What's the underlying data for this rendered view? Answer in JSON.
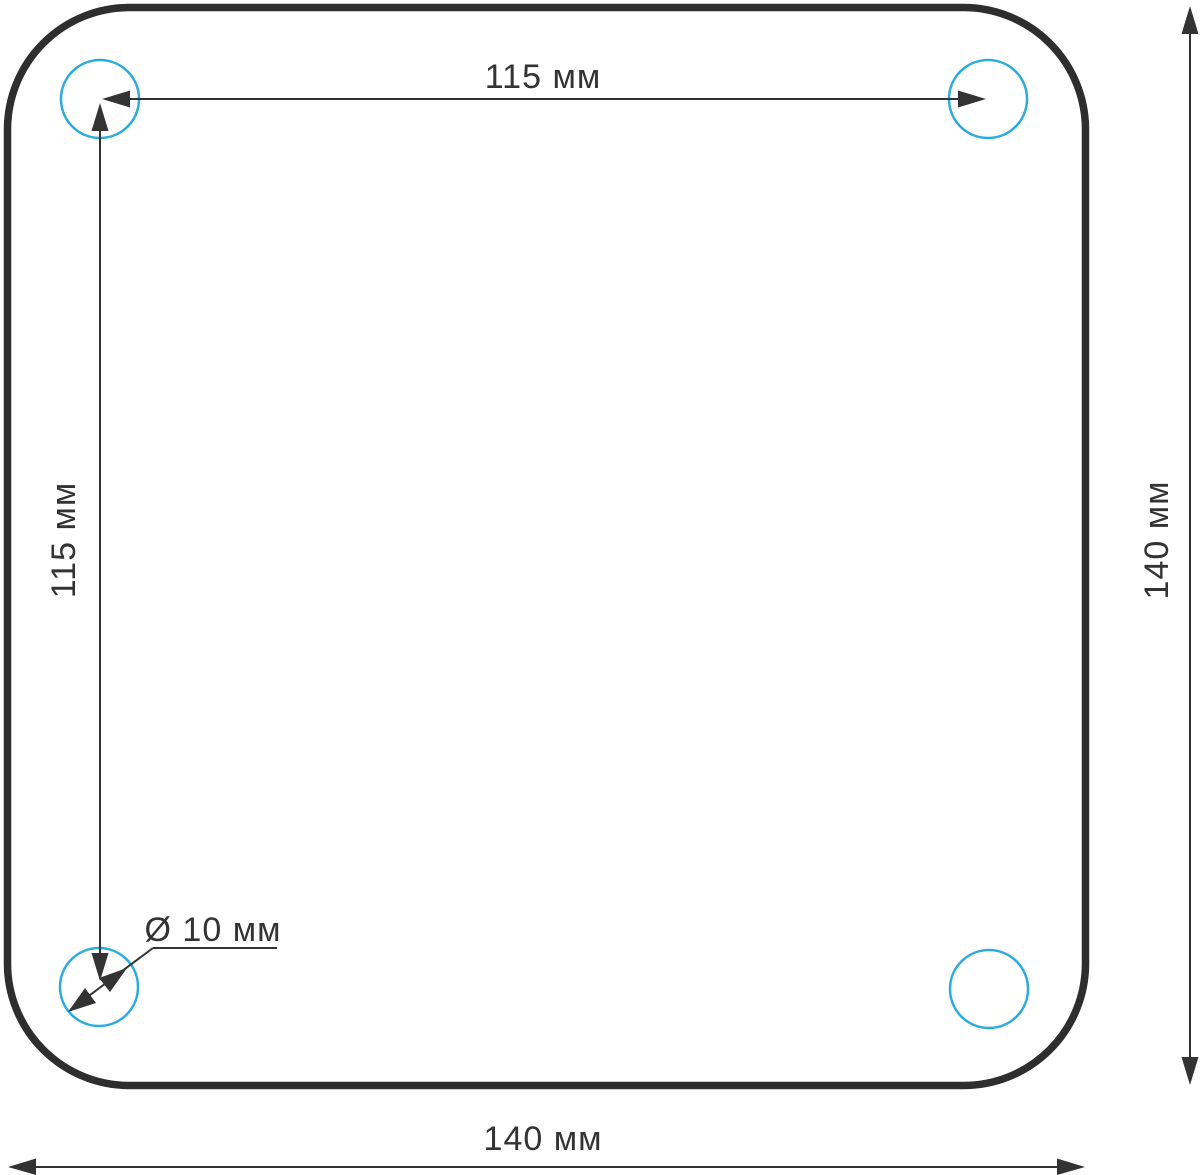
{
  "drawing": {
    "type": "technical-dimension-drawing",
    "subject": "square mounting plate with rounded corners and four drill holes",
    "colors": {
      "background": "#ffffff",
      "outline": "#2e2e2e",
      "hole_outline": "#29abe2",
      "dimension": "#333333"
    },
    "labels": {
      "hole_spacing_horizontal": "115 мм",
      "hole_spacing_vertical": "115 мм",
      "hole_diameter": "Ø 10 мм",
      "plate_width": "140 мм",
      "plate_height": "140 мм"
    },
    "values_mm": {
      "hole_spacing_x": 115,
      "hole_spacing_y": 115,
      "hole_diameter": 10,
      "plate_width": 140,
      "plate_height": 140
    }
  }
}
